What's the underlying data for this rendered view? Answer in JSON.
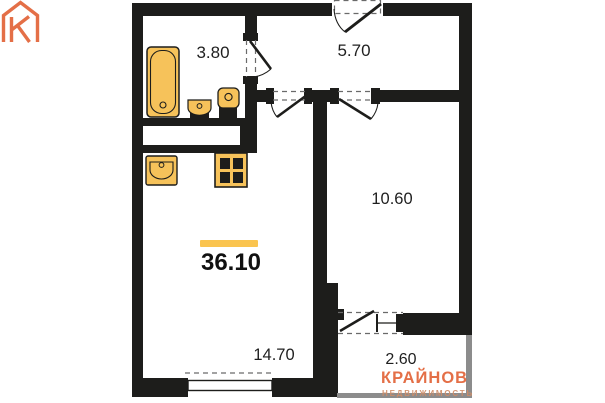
{
  "plan": {
    "title": "apartment-floor-plan",
    "total_area": "36.10",
    "rooms": [
      {
        "id": "bathroom",
        "area": "3.80"
      },
      {
        "id": "hallway",
        "area": "5.70"
      },
      {
        "id": "bedroom",
        "area": "10.60"
      },
      {
        "id": "living-kitchen",
        "area": "14.70"
      },
      {
        "id": "balcony",
        "area": "2.60"
      }
    ],
    "fixture_icons": [
      "bathtub-icon",
      "washbasin-icon",
      "toilet-icon",
      "kitchen-sink-icon",
      "stove-4-burner-icon",
      "entrance-door",
      "bathroom-door",
      "living-room-door",
      "bedroom-door",
      "balcony-door-window",
      "window"
    ]
  },
  "logo": {
    "brand": "КРАЙНОВ",
    "tagline": "НЕДВИЖИМОСТЬ"
  },
  "colors": {
    "wall": "#1d1d1b",
    "fixture": "#f6c25a",
    "accent": "#fac44f",
    "logo-orange": "#e2653a",
    "logo-tagline": "#cf8d68",
    "balcony-gray": "#8c8c8c",
    "label-dark": "#1f1f1f"
  }
}
